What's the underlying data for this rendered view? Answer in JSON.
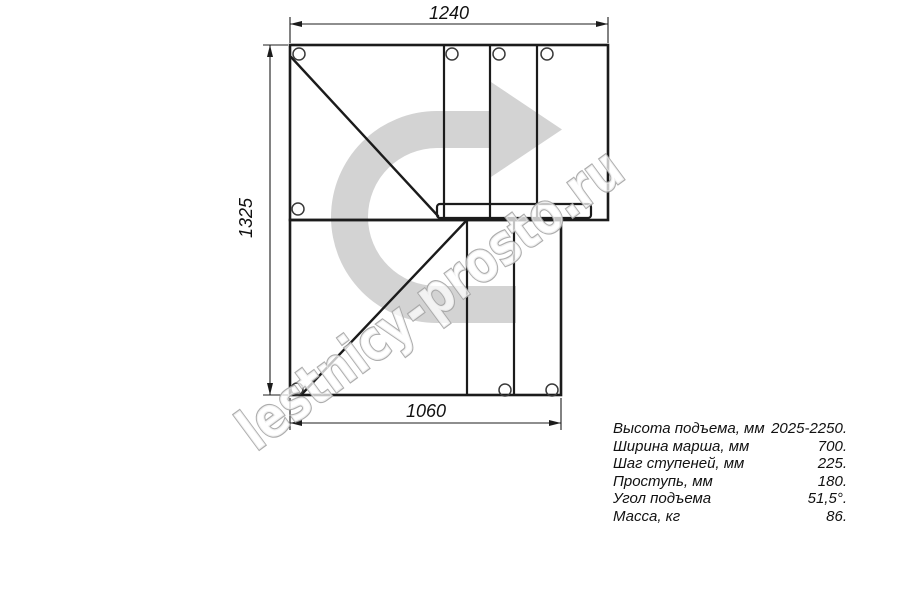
{
  "drawing": {
    "type": "staircase-plan-top-view",
    "dimensions": {
      "top": "1240",
      "left": "1325",
      "bottom": "1060"
    }
  },
  "watermark": {
    "text": "lestnicy-prosto.ru"
  },
  "specs": {
    "rows": [
      {
        "label": "Высота подъема, мм",
        "value": "2025-2250."
      },
      {
        "label": "Ширина марша, мм",
        "value": "700."
      },
      {
        "label": "Шаг ступеней, мм",
        "value": "225."
      },
      {
        "label": "Проступь, мм",
        "value": "180."
      },
      {
        "label": "Угол подъема",
        "value": "51,5°."
      },
      {
        "label": "Масса, кг",
        "value": "86."
      }
    ]
  },
  "colors": {
    "background": "#ffffff",
    "line": "#1b1b1b",
    "direction_arrow": "#d3d3d3",
    "watermark_stroke": "#a5a5a5",
    "dimension_text": "#111111"
  }
}
